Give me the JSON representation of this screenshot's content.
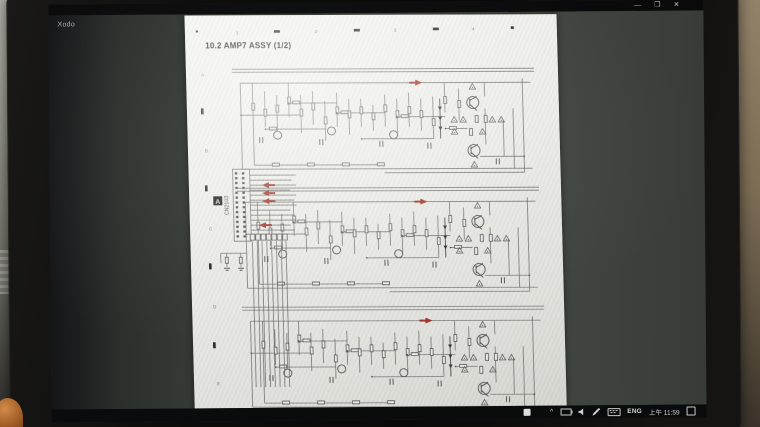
{
  "window": {
    "app_title": "Xodo",
    "minimize": "—",
    "maximize": "❐",
    "close": "✕"
  },
  "document": {
    "title": "10.2  AMP7 ASSY (1/2)",
    "grid_columns": [
      "1",
      "2",
      "3",
      "4"
    ],
    "grid_rows": [
      "A",
      "B",
      "C",
      "D",
      "E"
    ],
    "connector_label": "CN2103",
    "zone_marker": "A"
  },
  "taskbar": {
    "language": "ENG",
    "time": "上午 11:59",
    "icons": {
      "chevron_up": "^",
      "battery": "css-battery-shape",
      "volume": "css-speaker-shape",
      "pen": "css-pen-shape",
      "keyboard": "css-keyboard-shape",
      "action_center": "css-square-shape"
    }
  },
  "colors": {
    "signal_arrow_red": "#9e2f22",
    "viewer_background": "#42463f",
    "page_background": "#ececе8",
    "taskbar_background": "#0a0b0d"
  }
}
